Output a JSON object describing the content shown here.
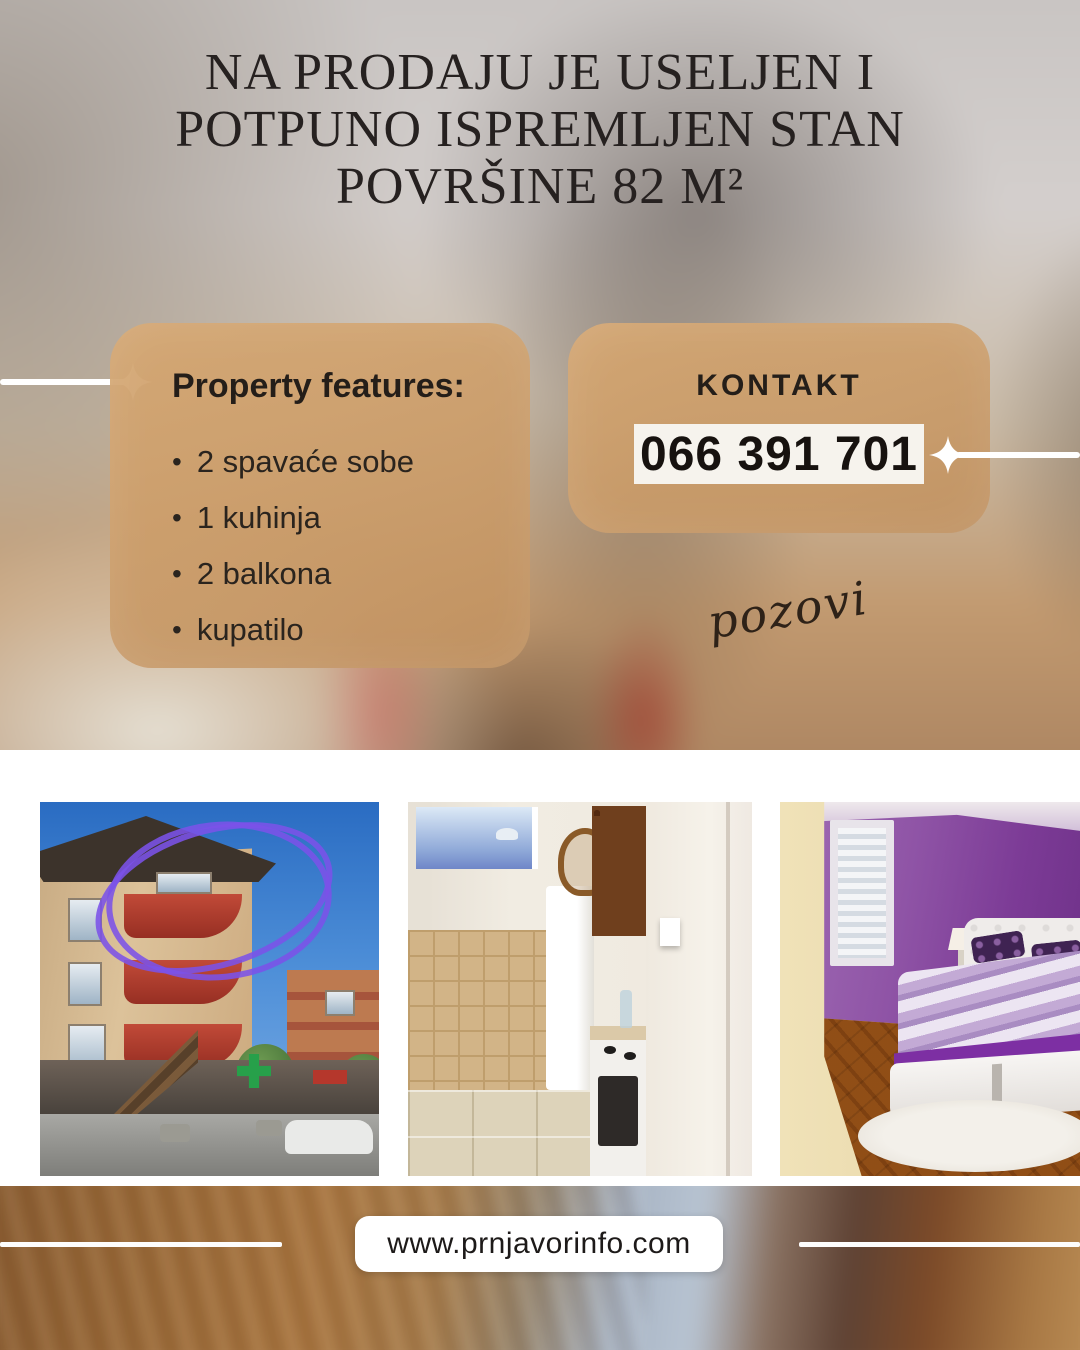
{
  "colors": {
    "card_tan": "#cf9f6b",
    "text_dark": "#262120",
    "phone_box_bg": "#f6f3ed",
    "accent_white": "#ffffff",
    "scribble_purple": "#7b52e8",
    "bedroom_purple": "#7c3b96",
    "balcony_red": "#c14a38"
  },
  "title": {
    "lines": [
      "NA PRODAJU JE USELJEN I",
      "POTPUNO ISPREMLJEN STAN",
      "POVRŠINE 82 M²"
    ]
  },
  "features_card": {
    "heading": "Property features:",
    "bullet": "•",
    "items": [
      "2 spavaće sobe",
      "1 kuhinja",
      "2 balkona",
      "kupatilo"
    ]
  },
  "contact_card": {
    "heading": "KONTAKT",
    "phone": "066 391 701",
    "note": "pozovi"
  },
  "photos": [
    {
      "name": "building-exterior",
      "depicts": "apartment building with red balconies, top-floor flat circled in purple"
    },
    {
      "name": "kitchen",
      "depicts": "kitchen with wooden cabinets, fridge and stove"
    },
    {
      "name": "bedroom",
      "depicts": "purple bedroom with double bed and white rug"
    }
  ],
  "footer": {
    "website": "www.prnjavorinfo.com"
  }
}
